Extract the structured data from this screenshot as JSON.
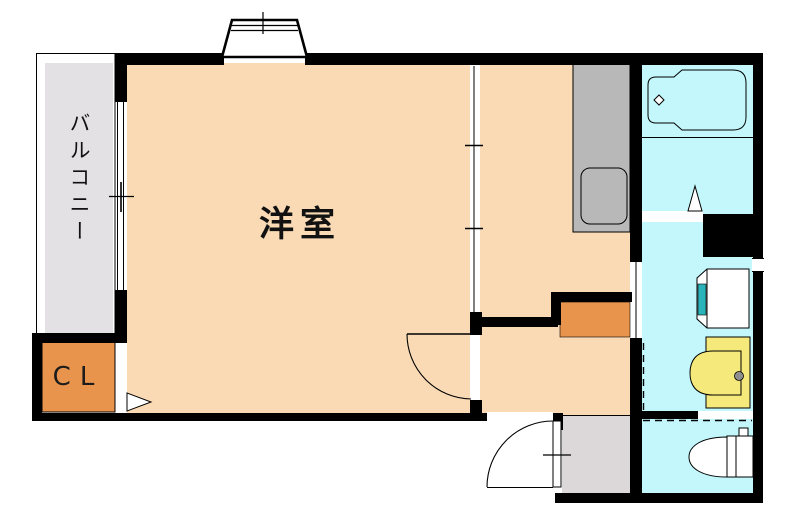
{
  "plan": {
    "type": "apartment-floor-plan",
    "rooms": [
      {
        "id": "room",
        "label": "洋室"
      },
      {
        "id": "balcony",
        "label": "バルコニー"
      },
      {
        "id": "closet",
        "label": "CL"
      }
    ],
    "fixtures": [
      "bay-window",
      "balcony-sliding-window",
      "sliding-partition",
      "kitchen-counter",
      "kitchen-sink",
      "bathtub",
      "bathroom-folding-door",
      "washbasin",
      "vanity-basin",
      "toilet",
      "hallway-storage",
      "room-door",
      "entrance-door",
      "washroom-sliding-door",
      "washing-machine-space-dashed-boundary"
    ]
  },
  "colors": {
    "room_floor": "#f9dab4",
    "wet_floor": "#c3f7fb",
    "balcony_floor": "#e4e1e4",
    "genkan_floor": "#dcd8d9",
    "closet_orange": "#e8944d",
    "counter_gray": "#b8b8b8",
    "vanity_yellow": "#f6e97b",
    "accent_teal": "#2ab4ba",
    "knob_gray": "#8f8f8f",
    "wall_black": "#000000",
    "fixture_white": "#ffffff"
  }
}
